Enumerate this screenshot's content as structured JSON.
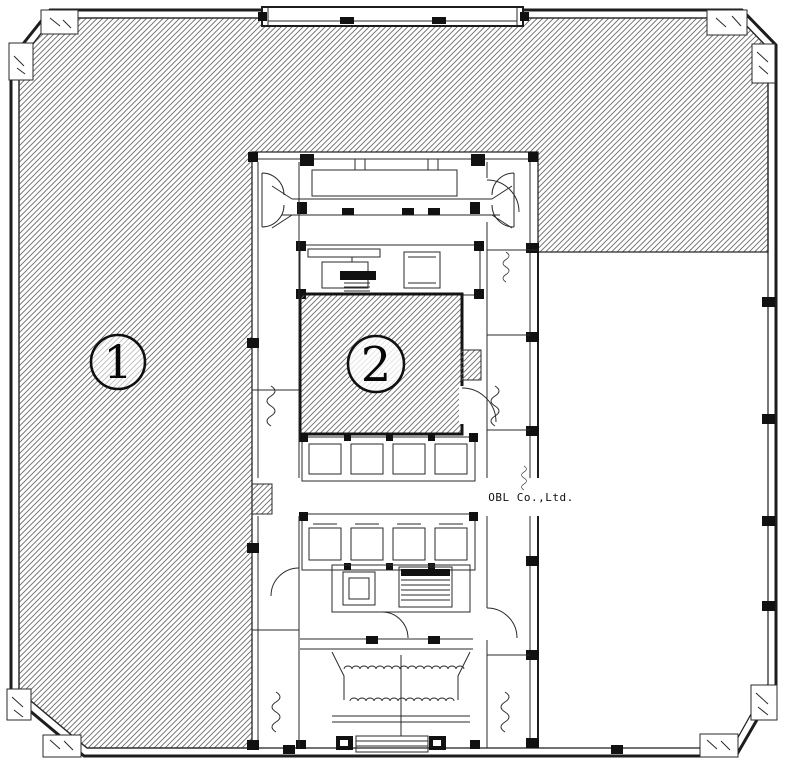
{
  "drawing": {
    "type": "architectural floor plan",
    "company_label": "OBL Co.,Ltd.",
    "zone_labels": {
      "zone1": "1",
      "zone2": "2"
    },
    "colors": {
      "background": "#ffffff",
      "wall_line": "#1d1d1d",
      "hatch_line": "#6b6b6b",
      "label_text": "#070707"
    },
    "core": {
      "elevator_rows": 2,
      "elevators_per_row": 4
    }
  }
}
